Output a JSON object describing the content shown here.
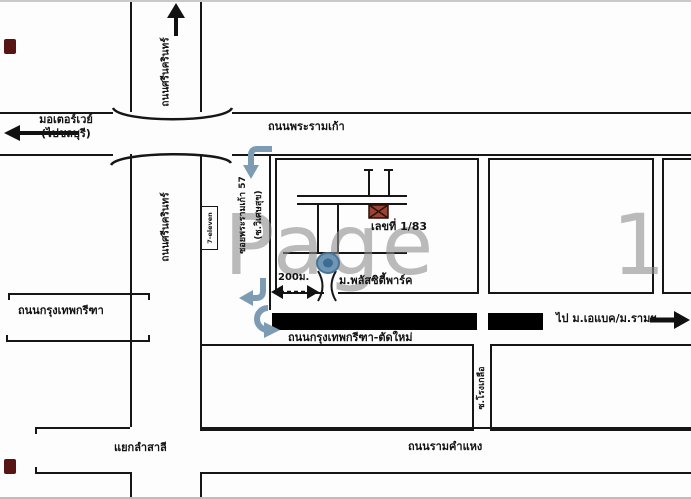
{
  "watermark": "Page 1",
  "colors": {
    "line": "#161616",
    "road_black": "#000000",
    "route_blue": "#7d9cb3",
    "house_fill": "#9a4434",
    "watermark_gray": "#8e8e8e"
  },
  "roads": {
    "rama9": "ถนนพระรามเก้า",
    "motorway_line1": "มอเตอร์เวย์",
    "motorway_line2": "(ไปชลบุรี)",
    "srinakarin_top": "ถนนศรีนครินทร์",
    "srinakarin_mid": "ถนนศรีนครินทร์",
    "krungthep_kreetha": "ถนนกรุงเทพกรีฑา",
    "krungthep_kreetha_new": "ถนนกรุงเทพกรีฑา-ตัดใหม่",
    "to_abac": "ไป ม.เอแบค/ม.รามฯ",
    "ramkhamhaeng": "ถนนรามคำแหง",
    "lam_sali": "แยกลำสาลี",
    "soi_vertical_line1": "ซอยพระรามเก้า 57",
    "soi_vertical_line2": "(ซ.วิเศษสุข)",
    "soi_bottom": "ซ.โรงเกลือ"
  },
  "landmarks": {
    "house_no": "เลขที่ 1/83",
    "village": "ม.พลัสซิตี้พาร์ค",
    "distance": "200ม.",
    "shop": "7-eleven"
  }
}
